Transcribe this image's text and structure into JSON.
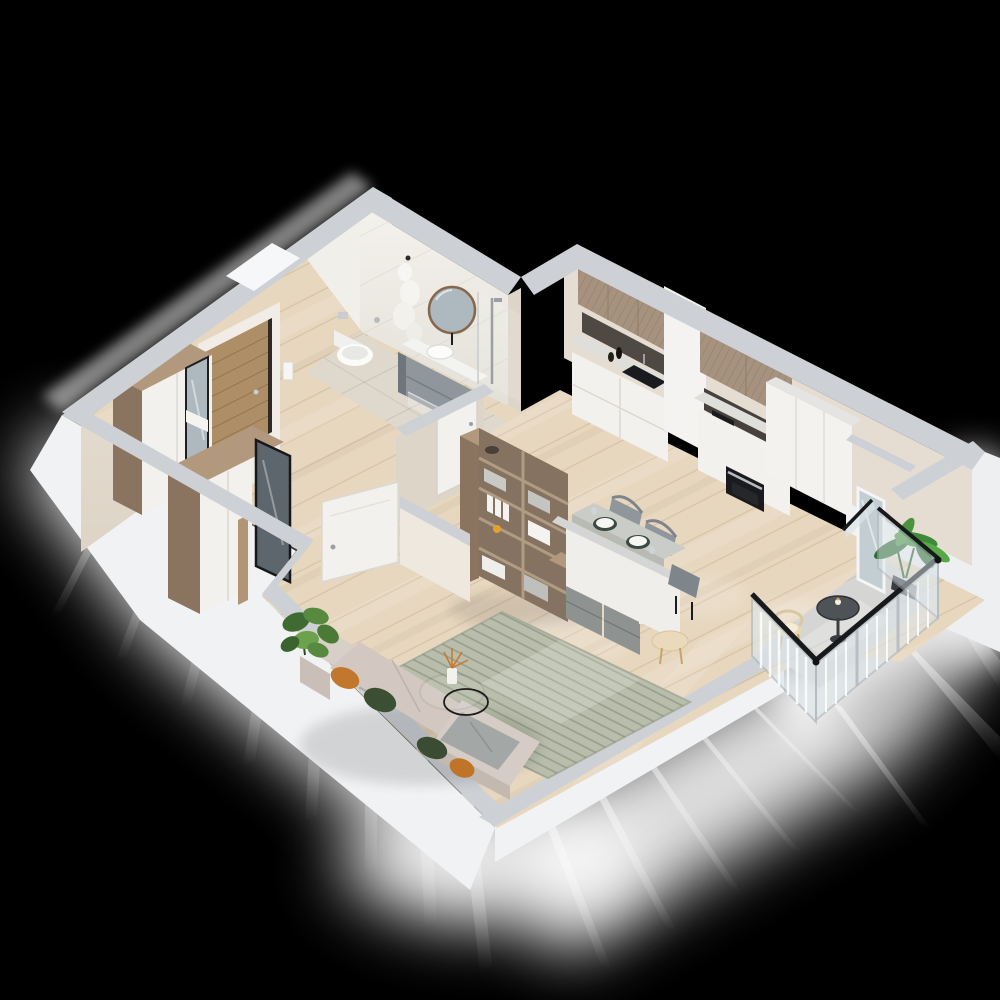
{
  "meta": {
    "title": "isometric-3d-apartment-floor-plan-render",
    "description": "Photorealistic cut-away 3D floor plan of a studio apartment on black background"
  },
  "palette": {
    "background": "#000000",
    "glow": "#ffffff",
    "wall_cap": "#cdd1d6",
    "wall_cream": "#e8e1d5",
    "wall_cream_dark": "#ddd5c8",
    "wall_white": "#f1f2f4",
    "marble": "#efede7",
    "floor_wood": "#e7d7bf",
    "floor_tile_bath": "#ded8cd",
    "floor_tile_balcony": "#d5d6d3",
    "wood_furniture": "#b2997d",
    "wood_cabinet": "#a6927e",
    "wood_dark": "#8a7460",
    "white_furniture": "#f2f1ee",
    "countertop": "#dededa",
    "appliance_dark": "#1a1b1e",
    "backsplash": "#4e4943",
    "sofa": "#d2c8c1",
    "rug": "#b9bdab",
    "pillow_orange": "#c2782c",
    "pillow_green": "#3c4f33",
    "blanket": "#a3a8a6",
    "plant": "#4c8038",
    "chair_gray": "#8f969c",
    "mirror_glass": "#aeb9bf",
    "mirror_frame": "#8a6b4e",
    "rail_glass": "#dde6ea",
    "rail_frame": "#b3bac1",
    "handrail": "#17191c",
    "door_wood": "#ad8e67",
    "accent_orange": "#e2a12e"
  },
  "rooms": [
    {
      "id": "bathroom",
      "label": "bathroom",
      "furniture": [
        "wall-hung-toilet",
        "flush-plate",
        "toilet-paper-holder",
        "bathrobe",
        "round-mirror",
        "vessel-sink-vanity",
        "shower-column",
        "glass-shower-screen",
        "white-door"
      ]
    },
    {
      "id": "hallway",
      "label": "entrance hall",
      "furniture": [
        "entrance-door",
        "intercom",
        "wardrobe-with-mirror",
        "second-wardrobe",
        "tall-mirror",
        "open-white-door",
        "monstera-plant"
      ]
    },
    {
      "id": "kitchen",
      "label": "kitchen",
      "furniture": [
        "upper-wood-cabinets",
        "dark-backsplash",
        "sink",
        "faucet",
        "white-base-cabinets",
        "coffee-machine",
        "cooktop",
        "oven",
        "tall-white-cabinets"
      ]
    },
    {
      "id": "dining",
      "label": "dining area",
      "furniture": [
        "white-table-with-gray-top",
        "place-settings",
        "gray-shell-chairs",
        "half-wall",
        "round-side-table"
      ]
    },
    {
      "id": "living",
      "label": "living room",
      "furniture": [
        "corner-sofa",
        "orange-pillows",
        "green-pillows",
        "gray-blanket",
        "wire-coffee-table",
        "vase-with-twigs",
        "green-rug",
        "open-shelving-unit",
        "sideboard-with-gray-drawers",
        "oranges-bowl"
      ]
    },
    {
      "id": "balcony",
      "label": "balcony",
      "furniture": [
        "glass-railing",
        "black-handrail",
        "round-bistro-table",
        "candle",
        "rattan-chair",
        "tall-plant",
        "glazed-balcony-door"
      ]
    }
  ]
}
